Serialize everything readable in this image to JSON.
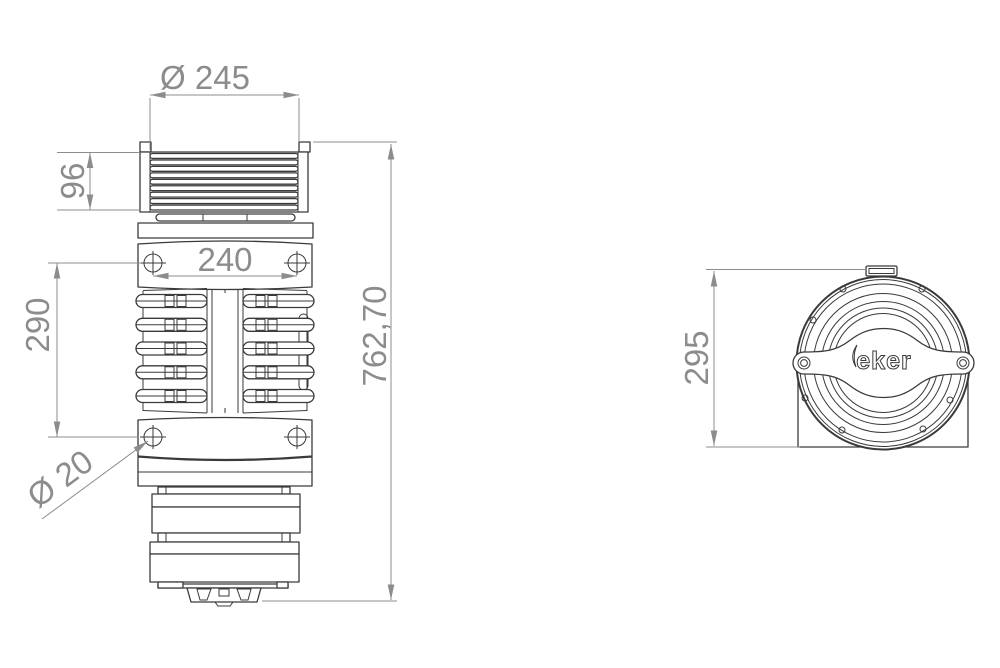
{
  "drawing": {
    "dimensions": {
      "top_diameter": "Ø 245",
      "fin_stack_height": "96",
      "screw_spacing_horizontal": "240",
      "screw_spacing_vertical": "290",
      "screw_diameter": "Ø 20",
      "overall_length": "762,70",
      "side_view_height": "295"
    },
    "logo_text": "eker",
    "colors": {
      "background": "#ffffff",
      "part_line": "#3a3a3a",
      "dimension_line": "#8c8c8c",
      "dimension_text": "#8c8c8c"
    }
  }
}
